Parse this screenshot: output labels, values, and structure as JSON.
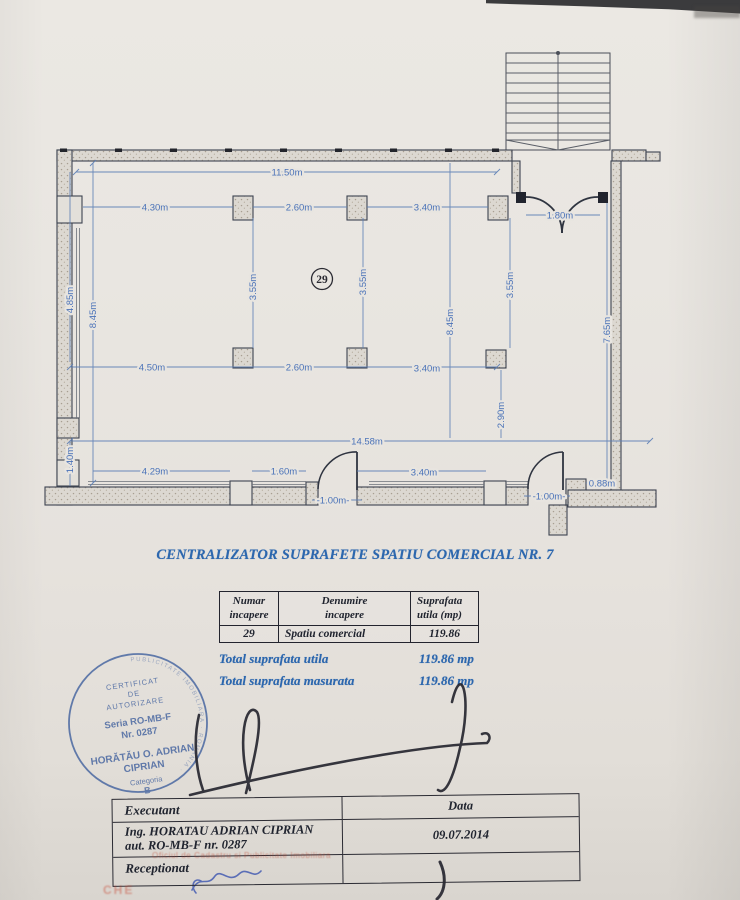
{
  "title": "CENTRALIZATOR SUPRAFETE SPATIU COMERCIAL NR. 7",
  "colors": {
    "paper": "#e8e5e0",
    "dimension_blue": "#4a72b8",
    "title_blue": "#2c67ae",
    "stamp_blue": "#44639f",
    "ink": "#23242e",
    "faint_red": "#c1422a"
  },
  "plan": {
    "room_number": "29",
    "dims": {
      "top_overall": "11.50m",
      "top_1": "4.30m",
      "top_2": "2.60m",
      "top_3": "3.40m",
      "entrance": "1.80m",
      "left_1": "4.85m",
      "left_2": "8.45m",
      "left_3": "1.40m",
      "bay_1": "3.55m",
      "bay_2": "3.55m",
      "bay_3": "3.55m",
      "mid_vertical": "8.45m",
      "mid_1": "4.50m",
      "mid_2": "2.60m",
      "mid_3": "3.40m",
      "right": "7.65m",
      "lower_right": "2.90m",
      "bottom_overall": "14.58m",
      "bottom_1": "4.29m",
      "bottom_2": "1.60m",
      "bottom_3": "3.40m",
      "door_1": "-1.00m-",
      "door_2": "-1.00m-",
      "corner": "0.88m"
    }
  },
  "surface_table": {
    "headers": {
      "col1a": "Numar",
      "col1b": "incapere",
      "col2a": "Denumire",
      "col2b": "incapere",
      "col3a": "Suprafata",
      "col3b": "utila (mp)"
    },
    "row": {
      "numar": "29",
      "denumire": "Spatiu comercial",
      "suprafata": "119.86"
    }
  },
  "totals": {
    "utila_label": "Total suprafata utila",
    "utila_value": "119.86 mp",
    "masurata_label": "Total suprafata masurata",
    "masurata_value": "119.86 mp"
  },
  "stamp": {
    "ring_text": "AGENTIA NATIONALA DE CADASTRU SI PUBLICITATE IMOBILIARA · ROMANIA ·",
    "line1": "CERTIFICAT",
    "line2": "DE",
    "line3": "AUTORIZARE",
    "line4": "Seria RO-MB-F",
    "line5": "Nr. 0287",
    "line6": "HORĂTĂU O. ADRIAN",
    "line7": "CIPRIAN",
    "line8": "Categoria",
    "line9": "B"
  },
  "exec_table": {
    "executant_label": "Executant",
    "data_label": "Data",
    "executant_line1": "Ing. HORATAU ADRIAN CIPRIAN",
    "executant_line2": "aut. RO-MB-F nr. 0287",
    "date": "09.07.2014",
    "receptionat_label": "Receptionat"
  },
  "red_marks": {
    "line1": "Oficiul de Cadastru si Publicitate Imobiliara",
    "line2": "CHE"
  }
}
